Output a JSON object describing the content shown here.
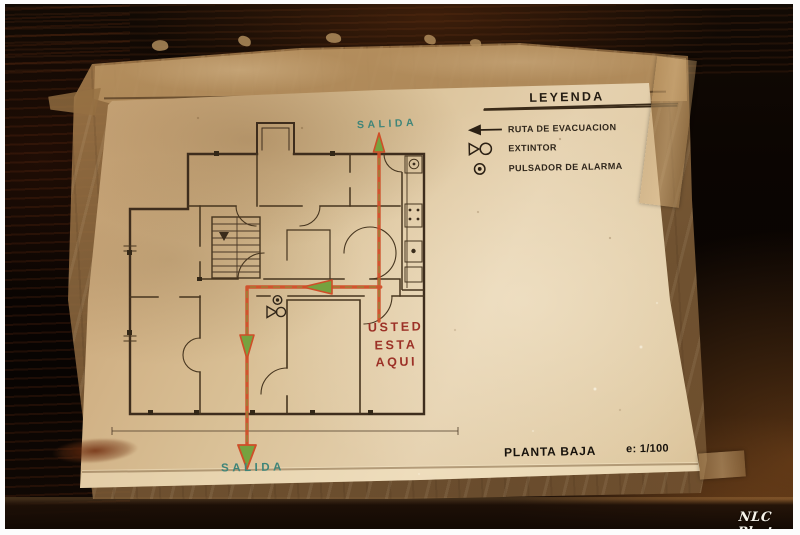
{
  "photo": {
    "watermark": "NLC Photo",
    "description": "Hand-drawn evacuation floor plan in a plastic sleeve taped to a dark wall"
  },
  "legend": {
    "title": "LEYENDA",
    "items": [
      {
        "icon": "evacuation-route-arrow-icon",
        "label": "RUTA DE EVACUACION"
      },
      {
        "icon": "fire-extinguisher-icon",
        "label": "EXTINTOR"
      },
      {
        "icon": "alarm-push-button-icon",
        "label": "PULSADOR DE ALARMA"
      }
    ]
  },
  "plan": {
    "exit_top_label": "SALIDA",
    "exit_bottom_label": "SALIDA",
    "you_are_here_lines": [
      "USTED",
      "ESTA",
      "AQUI"
    ],
    "floor_label": "PLANTA BAJA",
    "scale_label": "e: 1/100"
  },
  "colors": {
    "route_orange": "#cf4e28",
    "arrow_green": "#76a23f",
    "exit_text_green": "#3f8579",
    "you_are_here_red": "#9c3127",
    "paper_cream": "#dcc298",
    "ink_dark": "#2f261b"
  }
}
